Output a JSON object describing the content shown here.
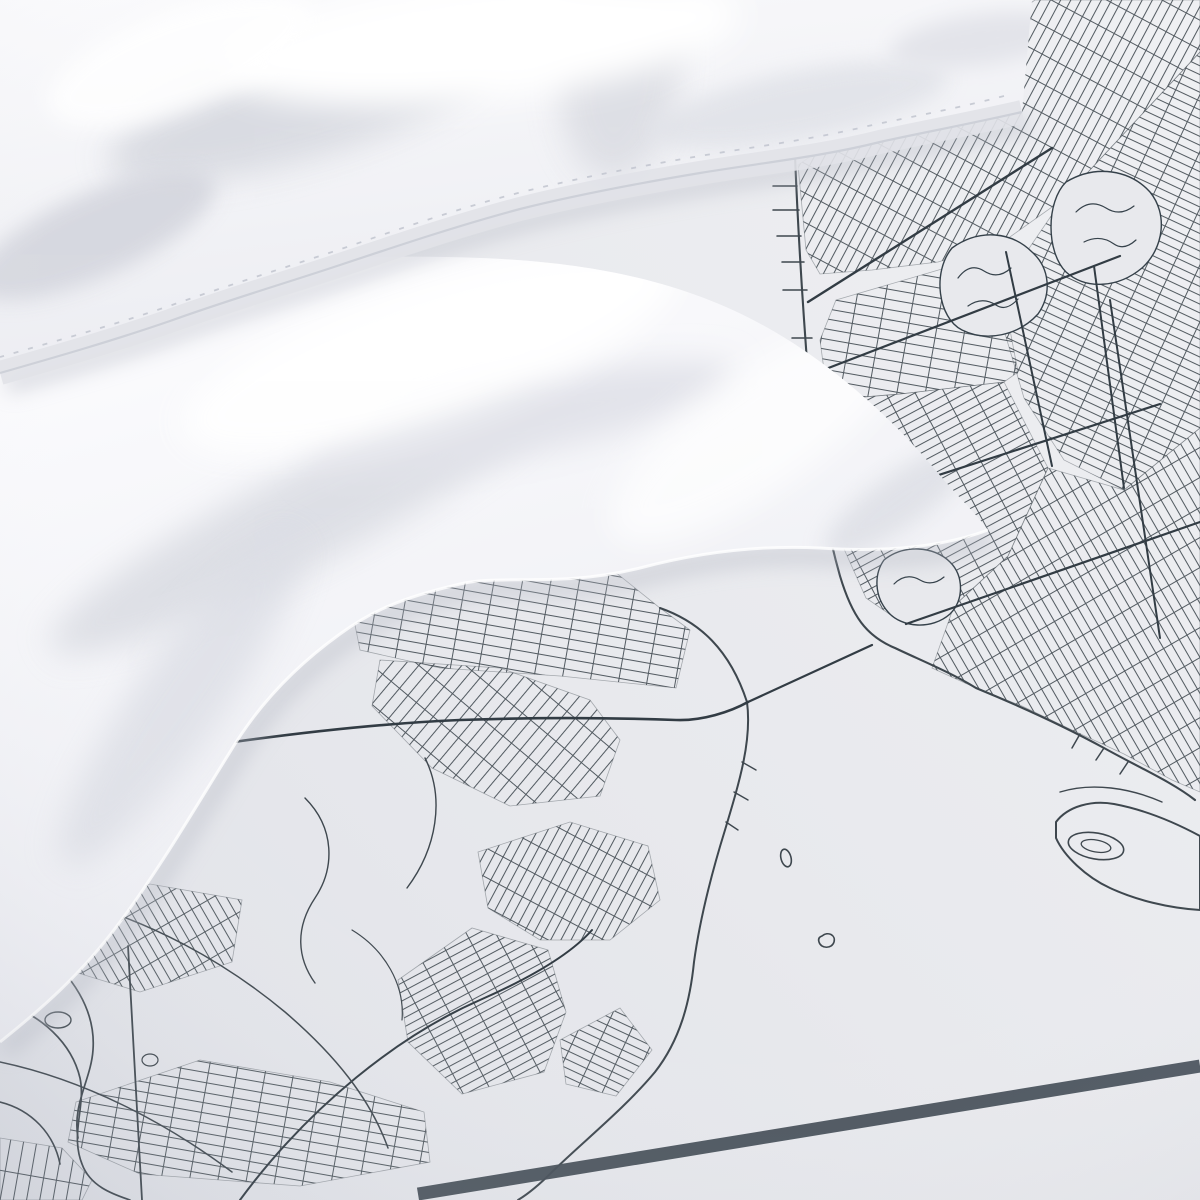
{
  "scene": {
    "type": "product-photograph",
    "subject": "white bedding set photographed on a duvet cover printed with a monochrome city street map of New York Harbor",
    "objects": [
      "fluffy white pillow with stitched flange hem",
      "folded white duvet corner",
      "map-printed duvet cover fabric",
      "thick printed map frame border rule"
    ],
    "map_features": [
      "dense street grids at varying angles",
      "waterfront shoreline with piers",
      "thin suspension-bridge line crossing a blank strait",
      "blank harbor water areas",
      "organic park and cemetery blobs with scribbled texture",
      "winding creeks and ponds",
      "peninsula with oval street loops",
      "two tiny harbor islands",
      "diagonal dark border rule near bottom"
    ]
  },
  "colors": {
    "fabric": "#e8e9ed",
    "fabric_hi": "#f0f1f4",
    "fabric_lo": "#dee0e6",
    "map_line": "#3e474e",
    "map_bold": "#323c44",
    "park_scribble": "#35414a",
    "border_rule": "#454e57",
    "white_hi": "#fdfdfe",
    "white_lo": "#e9eaef",
    "shadow": "#b6b9c4",
    "stitch": "#c3c6d0"
  }
}
